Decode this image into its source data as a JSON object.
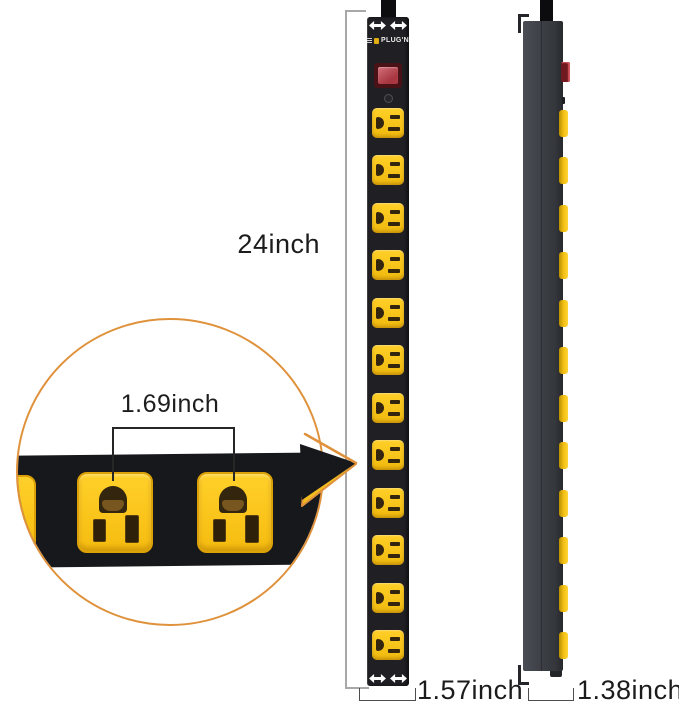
{
  "product": {
    "brand_label": "PLUG'N",
    "outlet_count": 12
  },
  "annotations": {
    "height": "24inch",
    "outlet_spacing": "1.69inch",
    "front_width": "1.57inch",
    "side_depth": "1.38inch"
  },
  "colors": {
    "strip_black": "#202024",
    "side_gray": "#3d4046",
    "outlet_yellow": "#f6bc0f",
    "slot_brown": "#33250e",
    "switch_red": "#a83742",
    "circle_orange": "#df923b",
    "dim_line_gray": "#a8a8a8",
    "label_text": "#1c1c1c"
  }
}
